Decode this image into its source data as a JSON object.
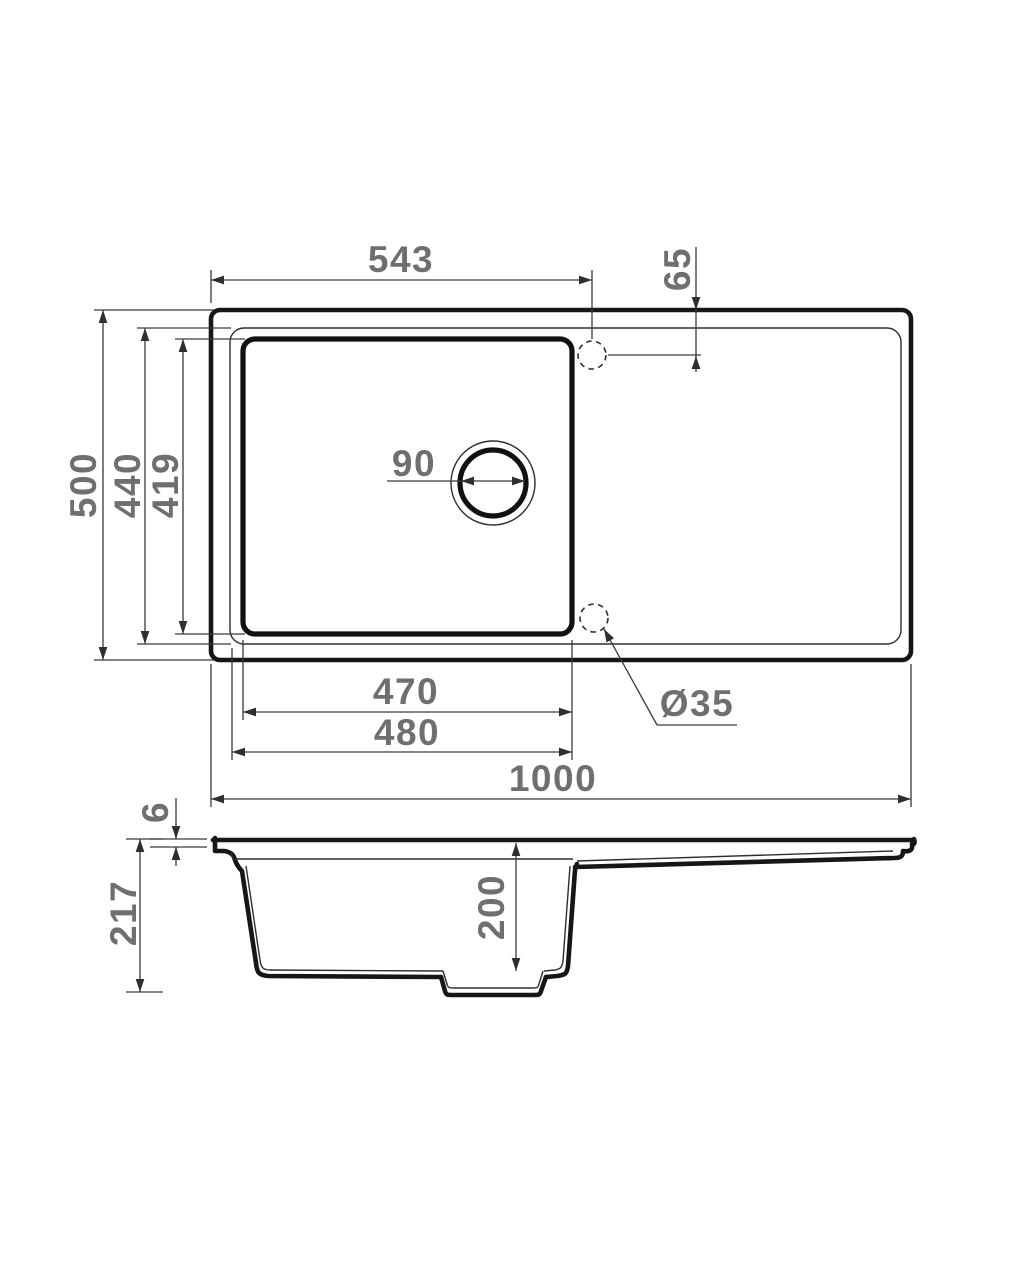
{
  "drawing": {
    "type": "technical-drawing",
    "subject": "kitchen sink with bowl and drainboard, top view and section view",
    "units": "mm",
    "colors": {
      "background": "#ffffff",
      "outline": "#161616",
      "dimension_lines": "#3a3a3a",
      "labels": "#6f6f6f"
    },
    "top_view": {
      "dims": {
        "tap_offset_x": "543",
        "tap_offset_y": "65",
        "overall_depth": "500",
        "inner_depth": "440",
        "bowl_depth": "419",
        "drain_diameter": "90",
        "bowl_width": "470",
        "bowl_width_outer": "480",
        "overall_width": "1000",
        "tap_hole_diameter": "Ø35"
      }
    },
    "section_view": {
      "dims": {
        "rim_thickness": "6",
        "overall_height": "217",
        "bowl_inner_depth": "200"
      }
    }
  }
}
